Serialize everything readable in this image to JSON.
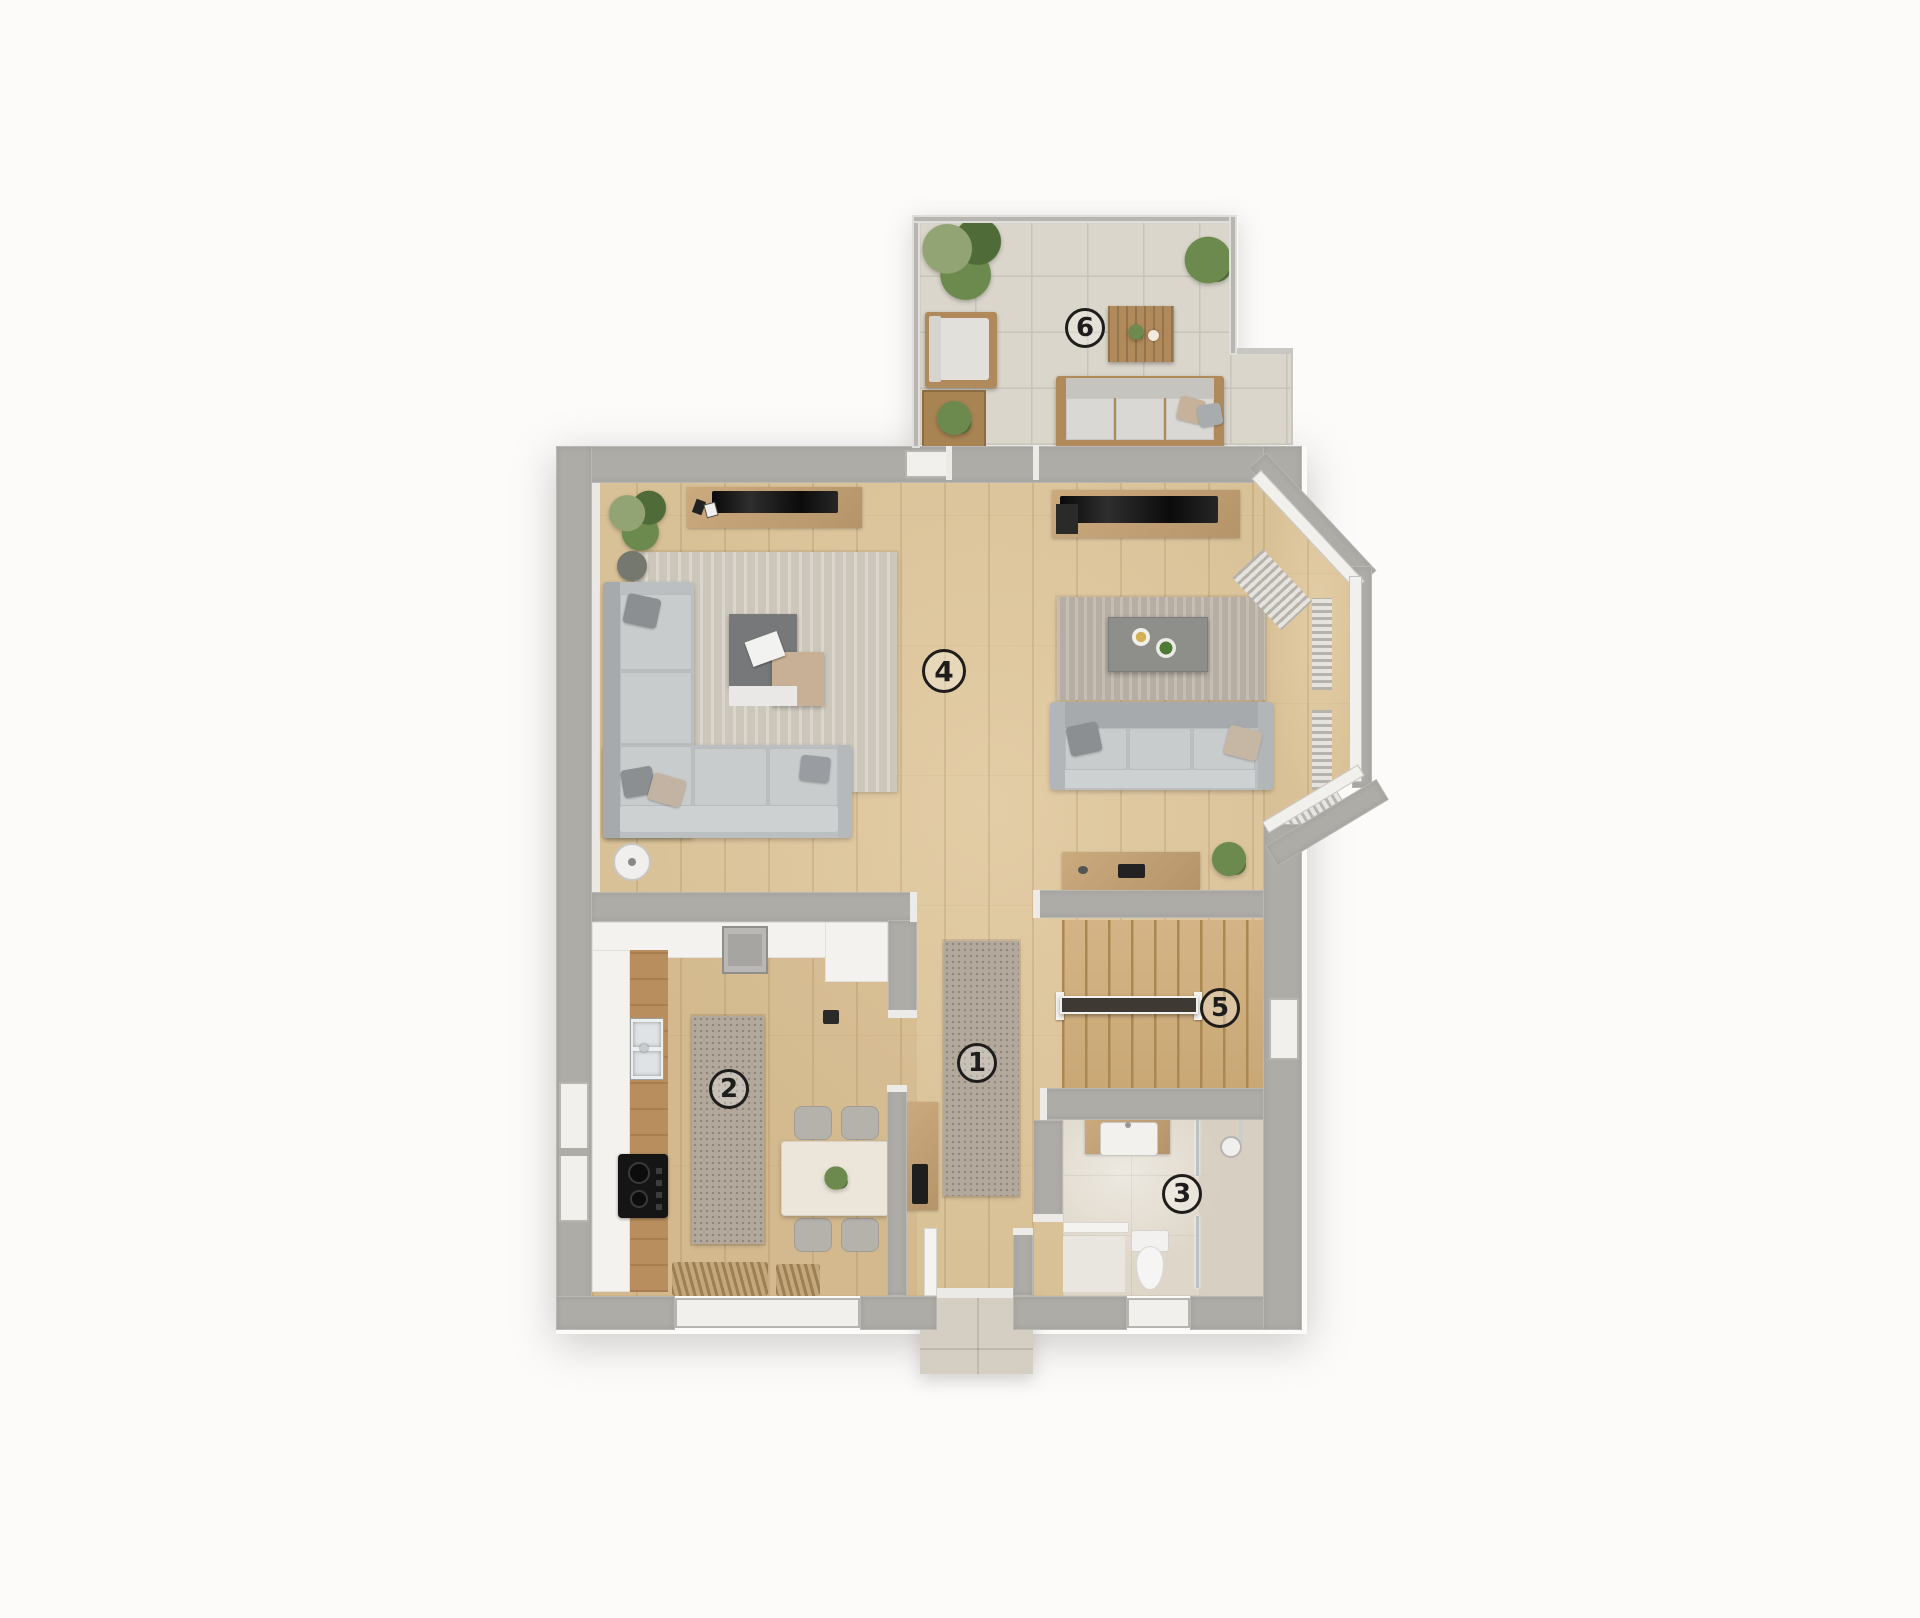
{
  "floorplan": {
    "type": "residential-floor-plan-top-view",
    "rooms": [
      {
        "number": "1",
        "name": "hallway"
      },
      {
        "number": "2",
        "name": "kitchen"
      },
      {
        "number": "3",
        "name": "bathroom"
      },
      {
        "number": "4",
        "name": "living-room"
      },
      {
        "number": "5",
        "name": "staircase"
      },
      {
        "number": "6",
        "name": "terrace"
      }
    ]
  },
  "colors": {
    "wall": "#aeaca7",
    "wall-light": "#c9c7c2",
    "cap": "#edebe7",
    "wood": "#d9c197",
    "wood-hi": "#e3cda6",
    "wood-line": "#c29e6c",
    "tile": "#dad6cb",
    "tile-line": "#c8c4b9",
    "bath": "#ded6c8",
    "shower": "#d6cec0",
    "porch": "#d5cfc3",
    "rug-left": "#ccc6bb",
    "rug-right": "#b6aea3",
    "runner": "#b2a89c",
    "runner-dot": "#8f857a",
    "stairs": "#cfae7e",
    "stairs-line": "#ab8752",
    "counter": "#f3f2ee",
    "counter-wood": "#b98e5e",
    "sofa": "#bcbfc1",
    "sofa-light": "#c9cccd",
    "sofa-dark": "#a7aaad",
    "sofa-front": "#ced1d2",
    "furn-wood": "#c3a277",
    "furn-wood-dark": "#b08a5a",
    "ink": "#1e1d1b",
    "white": "#f4f3f0",
    "frame": "#f1f0ec",
    "curtain": "#b4b2ad",
    "plant-dark": "#4e6b38",
    "plant-mid": "#6d8a4e",
    "plant-light": "#93a474",
    "bg": "#fcfbfa",
    "tv": "#1c1c1c"
  }
}
